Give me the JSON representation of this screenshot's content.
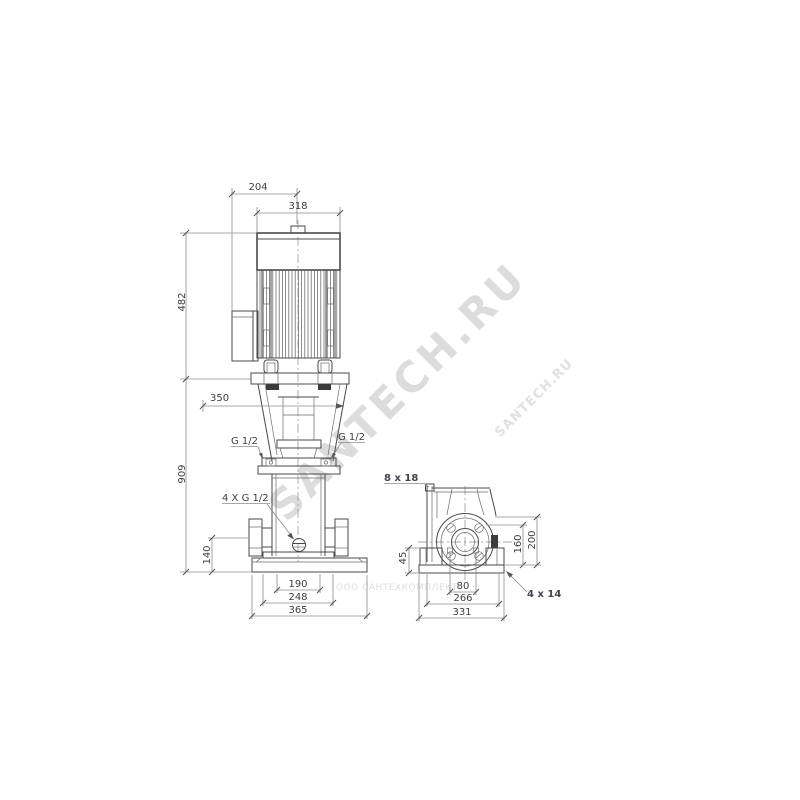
{
  "drawing": {
    "front_view": {
      "dim_204": "204",
      "dim_318": "318",
      "dim_482": "482",
      "dim_350": "350",
      "dim_909": "909",
      "port_left_label": "G 1/2",
      "port_right_label": "G 1/2",
      "drain_label": "4 X G 1/2",
      "dim_140": "140",
      "dim_190": "190",
      "dim_248": "248",
      "dim_365": "365"
    },
    "side_view": {
      "slot_label": "8 x 18",
      "dim_45": "45",
      "dim_80": "80",
      "dim_266": "266",
      "dim_331": "331",
      "dim_160": "160",
      "dim_200": "200",
      "hole_label": "4 x 14"
    },
    "watermarks": {
      "large": "SANTECH.RU",
      "small_diagonal": "SANTECH.RU",
      "company": "ООО САНТЕХКОМПЛЕКТ"
    },
    "colors": {
      "outline": "#4a4a4a",
      "dimension_line": "#8c8c8c",
      "text": "#3d3d46",
      "watermark": "#d4d4d4",
      "background": "#ffffff"
    }
  }
}
